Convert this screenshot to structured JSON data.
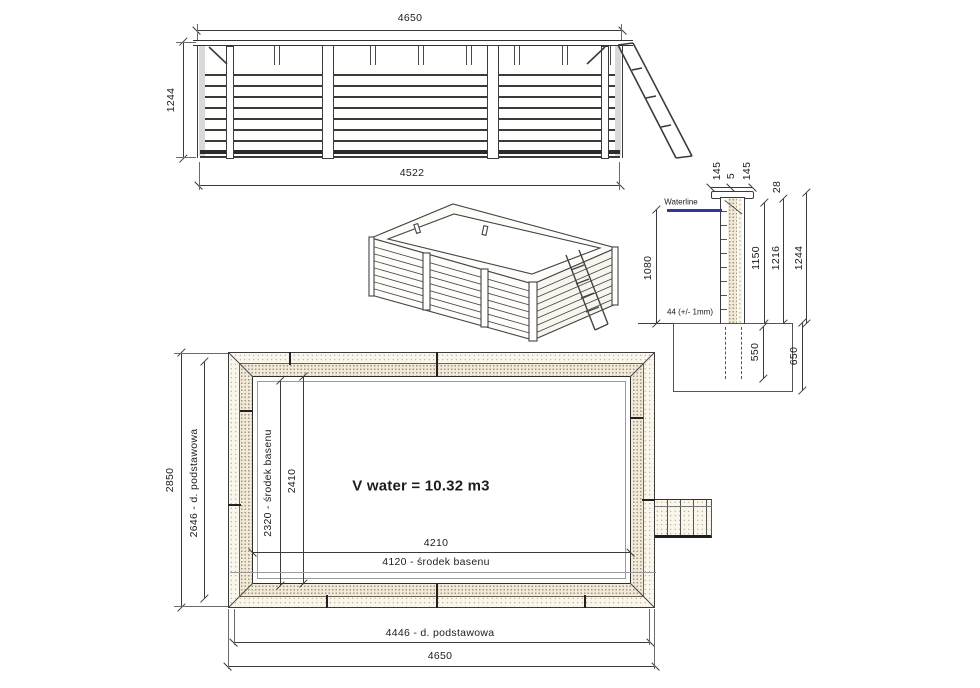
{
  "elevation": {
    "dim_top": "4650",
    "dim_height": "1244",
    "dim_bottom": "4522"
  },
  "section": {
    "waterline_label": "Waterline",
    "dim_water_depth": "1080",
    "dim_wall_thickness": "44 (+/- 1mm)",
    "dim_cap_outer": "145",
    "dim_cap_gap": "5",
    "dim_cap_inner": "145",
    "dim_rim_to_water": "28",
    "dim_wall_height": "1150",
    "dim_inner_height": "1216",
    "dim_total_height": "1244",
    "dim_post_embed": "550",
    "dim_foundation_depth": "650"
  },
  "plan": {
    "dim_overall_depth": "2850",
    "dim_base_depth": "2646 - d. podstawowa",
    "dim_center_depth": "2320 - środek basenu",
    "dim_inner_depth": "2410",
    "volume_label": "V water = 10.32 m3",
    "dim_inner_width": "4210",
    "dim_center_width": "4120 - środek basenu",
    "dim_base_width": "4446 - d. podstawowa",
    "dim_overall_width": "4650"
  },
  "colors": {
    "waterline_blue": "#2b3a99",
    "line_dark": "#3b3b3b",
    "wood_fill": "#f1ead9"
  }
}
